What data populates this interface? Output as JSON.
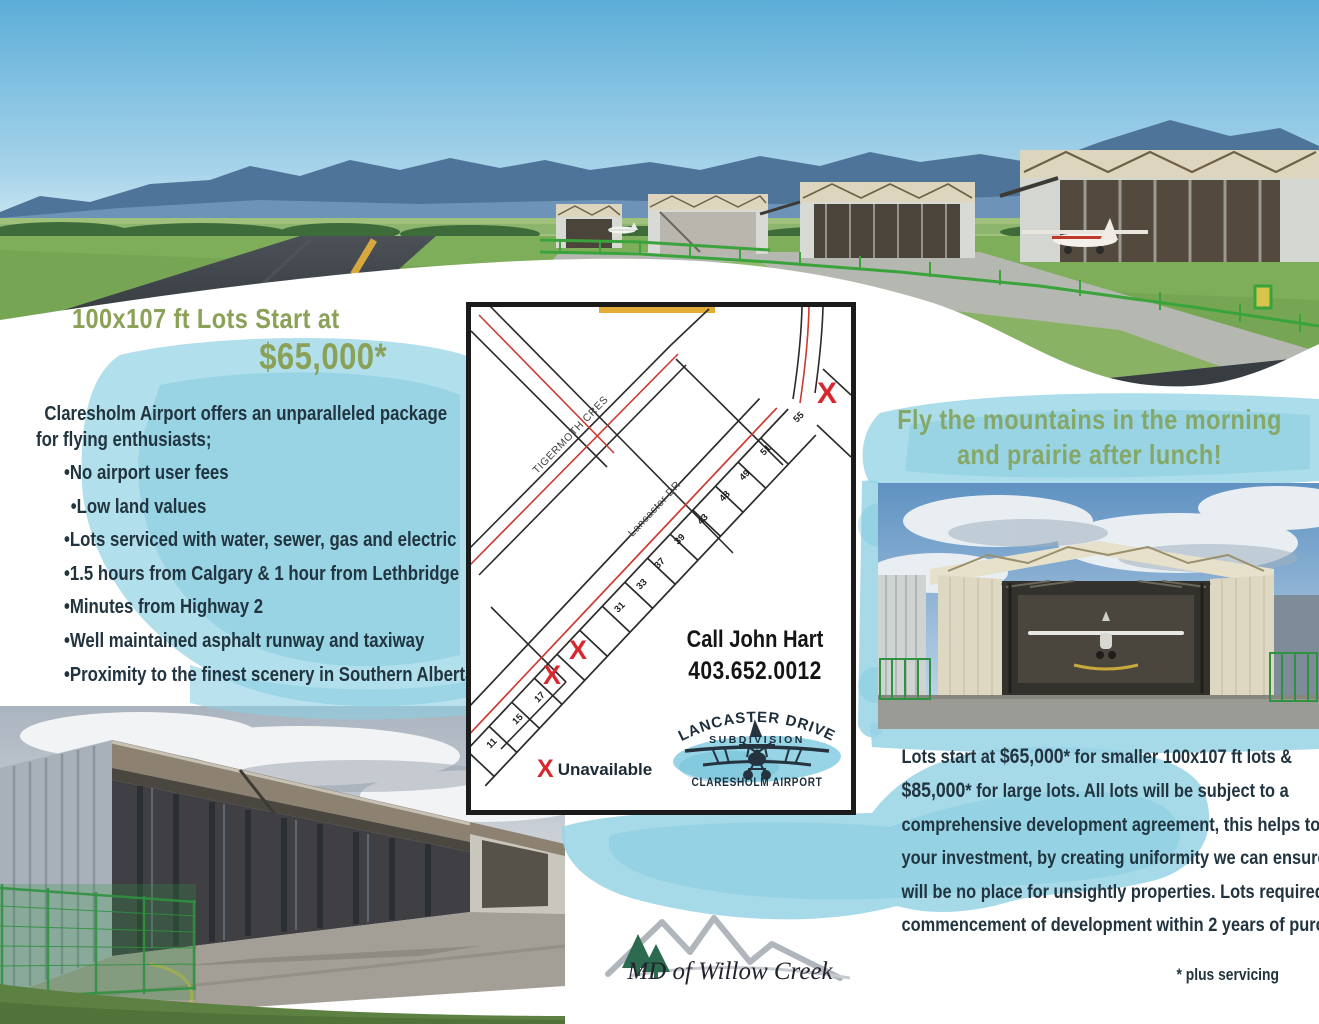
{
  "left": {
    "heading_line1": "100x107 ft Lots Start at",
    "heading_line2": "$65,000*",
    "intro_line1": "Claresholm Airport offers an unparalleled package",
    "intro_line2": "for flying enthusiasts;",
    "bullets": [
      "•No airport user fees",
      "•Low land values",
      "•Lots serviced with water, sewer, gas and electric",
      "•1.5 hours from Calgary & 1 hour from Lethbridge",
      "•Minutes from Highway 2",
      "•Well maintained asphalt runway and taxiway",
      "•Proximity to the finest scenery in Southern Alberta"
    ]
  },
  "right": {
    "heading_line1": "Fly the mountains in the morning",
    "heading_line2": "and prairie after lunch!"
  },
  "map": {
    "streets": {
      "tigermoth": "TIGERMOTH CRES",
      "lancaster": "Lancaster DR"
    },
    "lots": [
      "11",
      "15",
      "17",
      "31",
      "33",
      "37",
      "39",
      "43",
      "48",
      "49",
      "51",
      "55"
    ],
    "unavailable_x": "X",
    "legend": {
      "symbol": "X",
      "label": "Unavailable"
    },
    "contact": {
      "name": "Call John Hart",
      "phone": "403.652.0012"
    },
    "logo": {
      "arc": "LANCASTER DRIVE",
      "line2": "SUBDIVISION",
      "line3": "CLARESHOLM AIRPORT"
    }
  },
  "paragraph": {
    "l1a": "Lots start at ",
    "l1b": "$65,000",
    "l1c": "* for smaller 100x107 ft lots &",
    "l2a": "$85,000",
    "l2b": "* for large lots. All lots will be subject to a",
    "l3": "comprehensive development agreement, this helps to protect",
    "l4": "your investment, by creating uniformity we can ensure there",
    "l5": "will be no place for unsightly properties. Lots required",
    "l6": "commencement of development within 2 years of purchase."
  },
  "footer": {
    "logo_text": "MD of Willow Creek",
    "note": "* plus servicing"
  },
  "colors": {
    "accent_green": "#8aa157",
    "sage_green": "#85a768",
    "dark_text": "#21343f",
    "watercolor_blue": "#97d4e5",
    "map_red": "#cc3a30",
    "x_red": "#d7282f"
  }
}
